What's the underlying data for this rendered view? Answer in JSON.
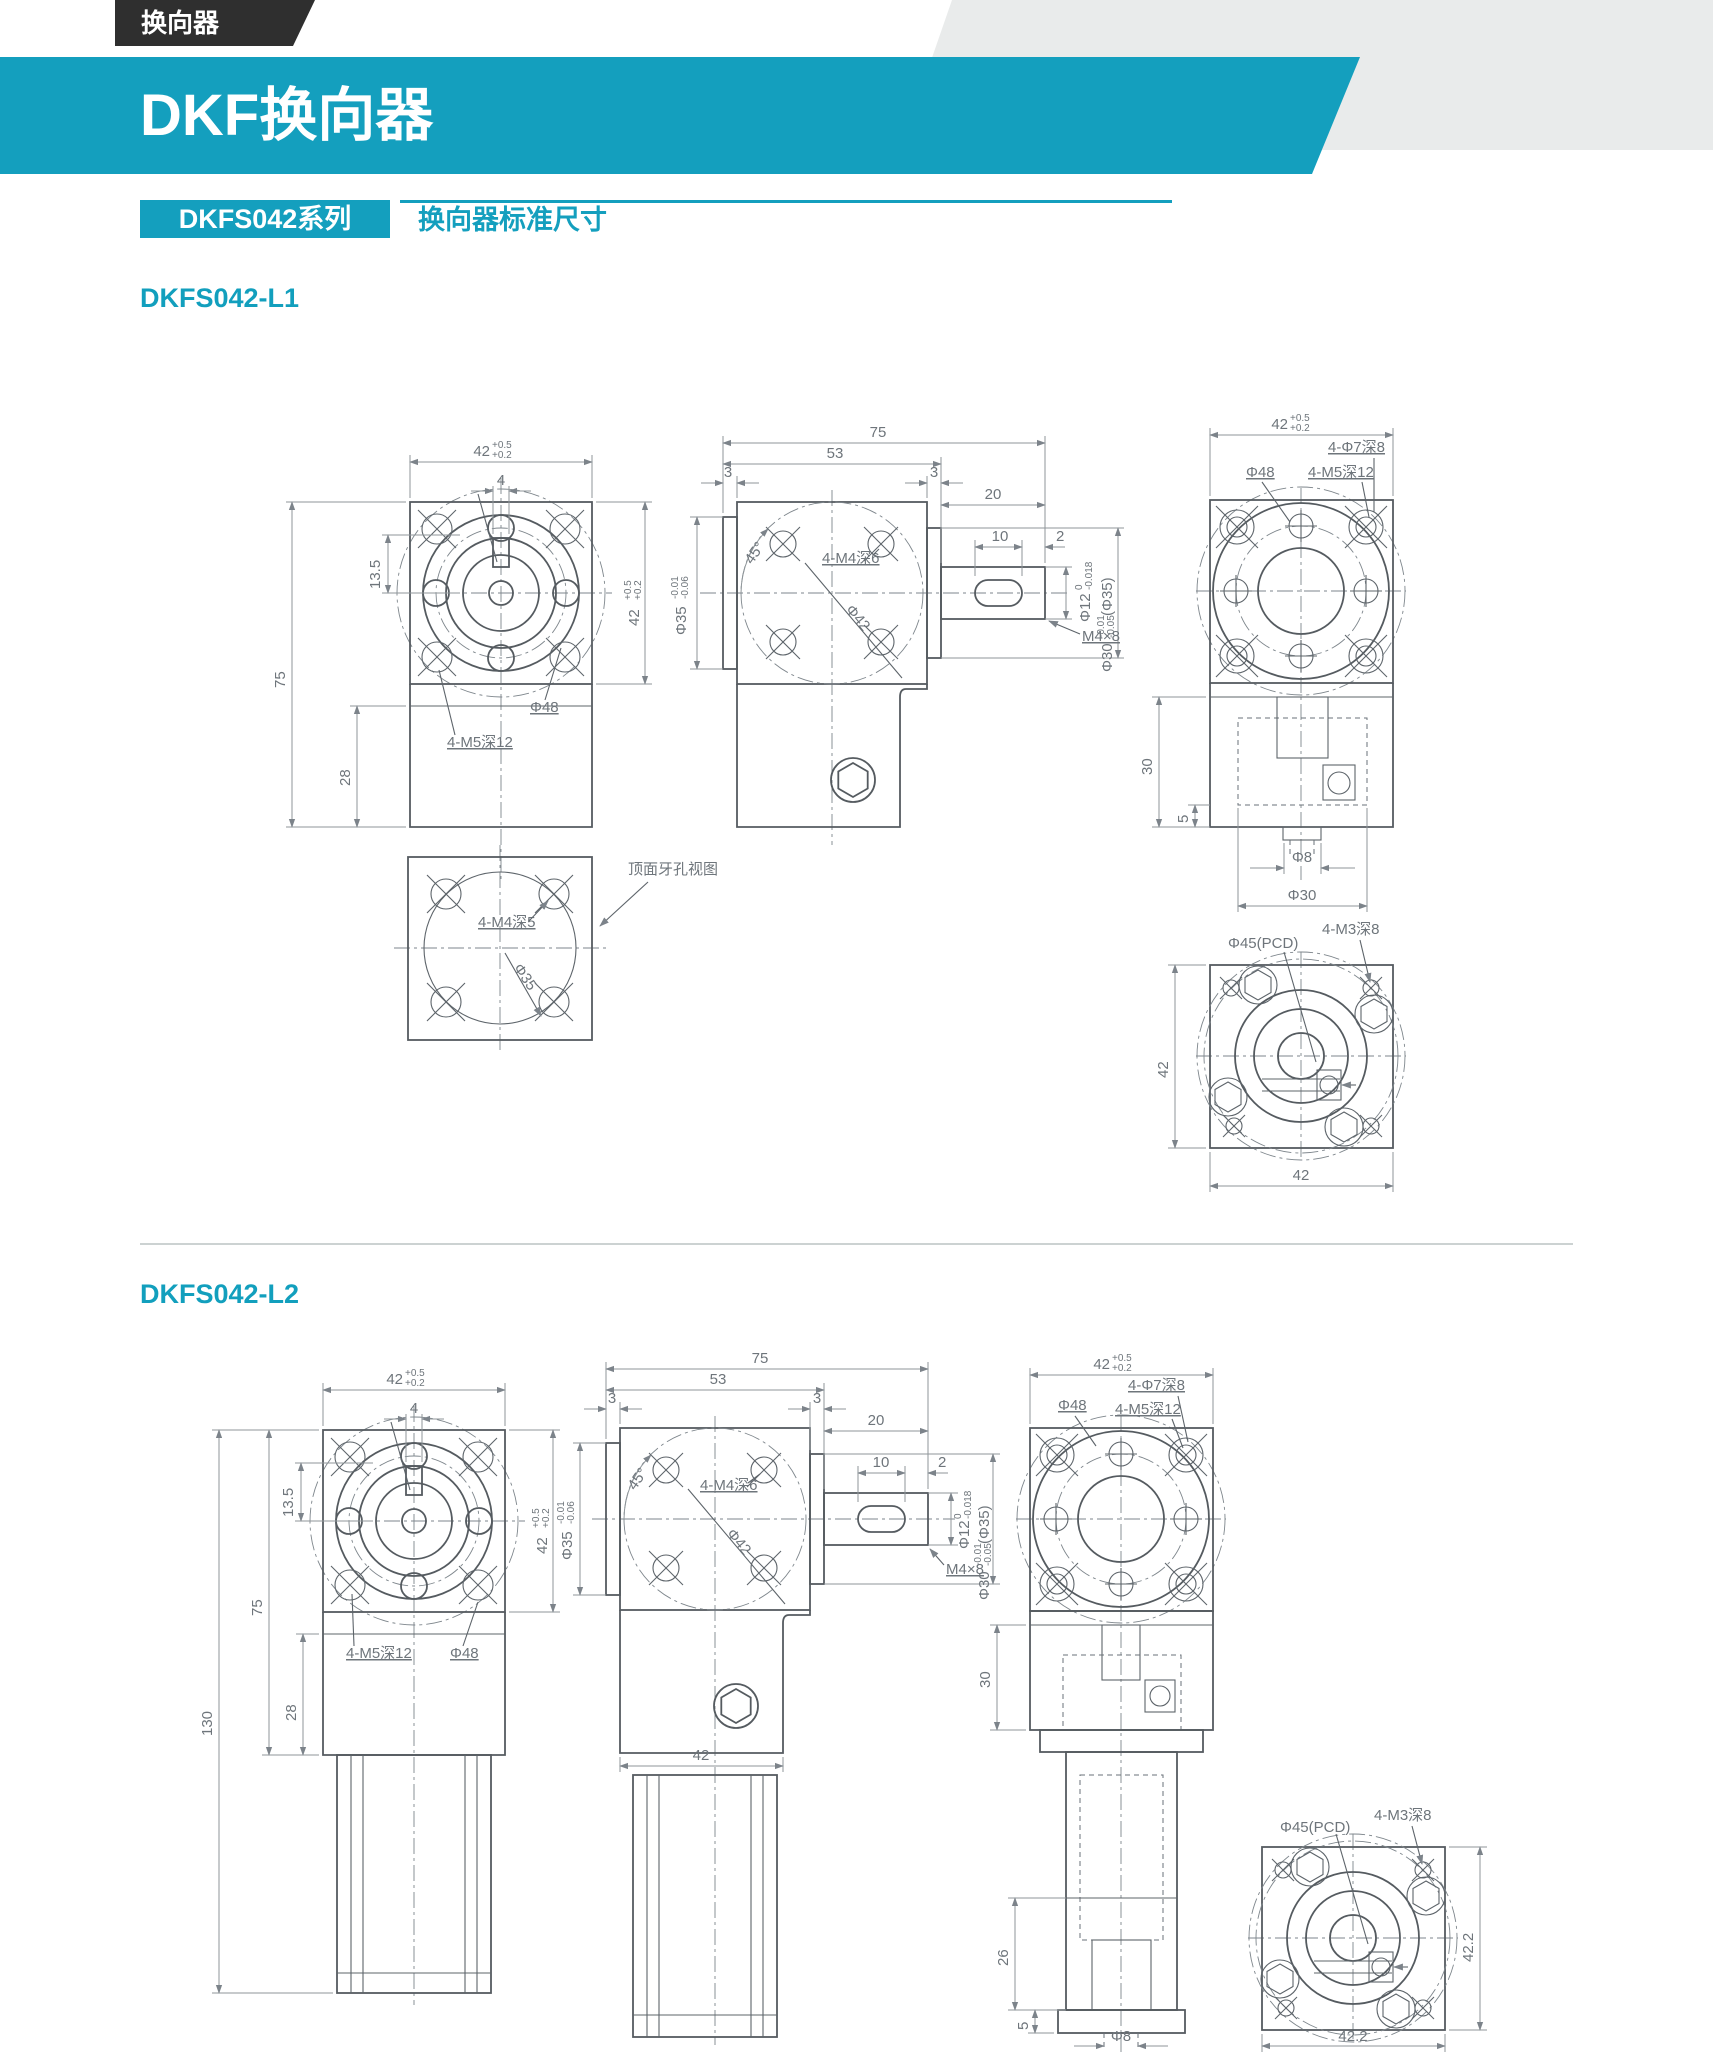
{
  "page": {
    "tab": "换向器",
    "title": "DKF换向器",
    "series": "DKFS042系列",
    "subtitle": "换向器标准尺寸"
  },
  "sections": {
    "l1": "DKFS042-L1",
    "l2": "DKFS042-L2"
  },
  "colors": {
    "teal": "#149fbe",
    "tab_black": "#2f2f2f",
    "gray_bg": "#e9ebeb",
    "line": "#555b60",
    "dim_text": "#6e757b"
  },
  "dims": {
    "d42": "42",
    "tp": "+0.5",
    "tm": "+0.2",
    "d4": "4",
    "d13_5": "13.5",
    "d75": "75",
    "d28": "28",
    "d130": "130",
    "d53": "53",
    "d3": "3",
    "d20": "20",
    "d10": "10",
    "d2": "2",
    "d30": "30",
    "d26": "26",
    "d5": "5",
    "d42_2": "42.2",
    "a45": "45°",
    "phi48": "Φ48",
    "phi42": "Φ42",
    "phi35": "Φ35",
    "phi30": "Φ30",
    "phi12": "Φ12",
    "phi8": "Φ8",
    "phi45": "Φ45(PCD)",
    "p35": "(Φ35)",
    "t0": "0",
    "tm018": "-0.018",
    "tm001": "-0.01",
    "tm006": "-0.06",
    "tm005": "-0.05",
    "m5d12": "4-M5深12",
    "m4d6": "4-M4深6",
    "m4d5": "4-M4深5",
    "m3d8": "4-M3深8",
    "p7d8": "4-Φ7深8",
    "m4x8": "M4×8",
    "note": "顶面牙孔视图"
  }
}
